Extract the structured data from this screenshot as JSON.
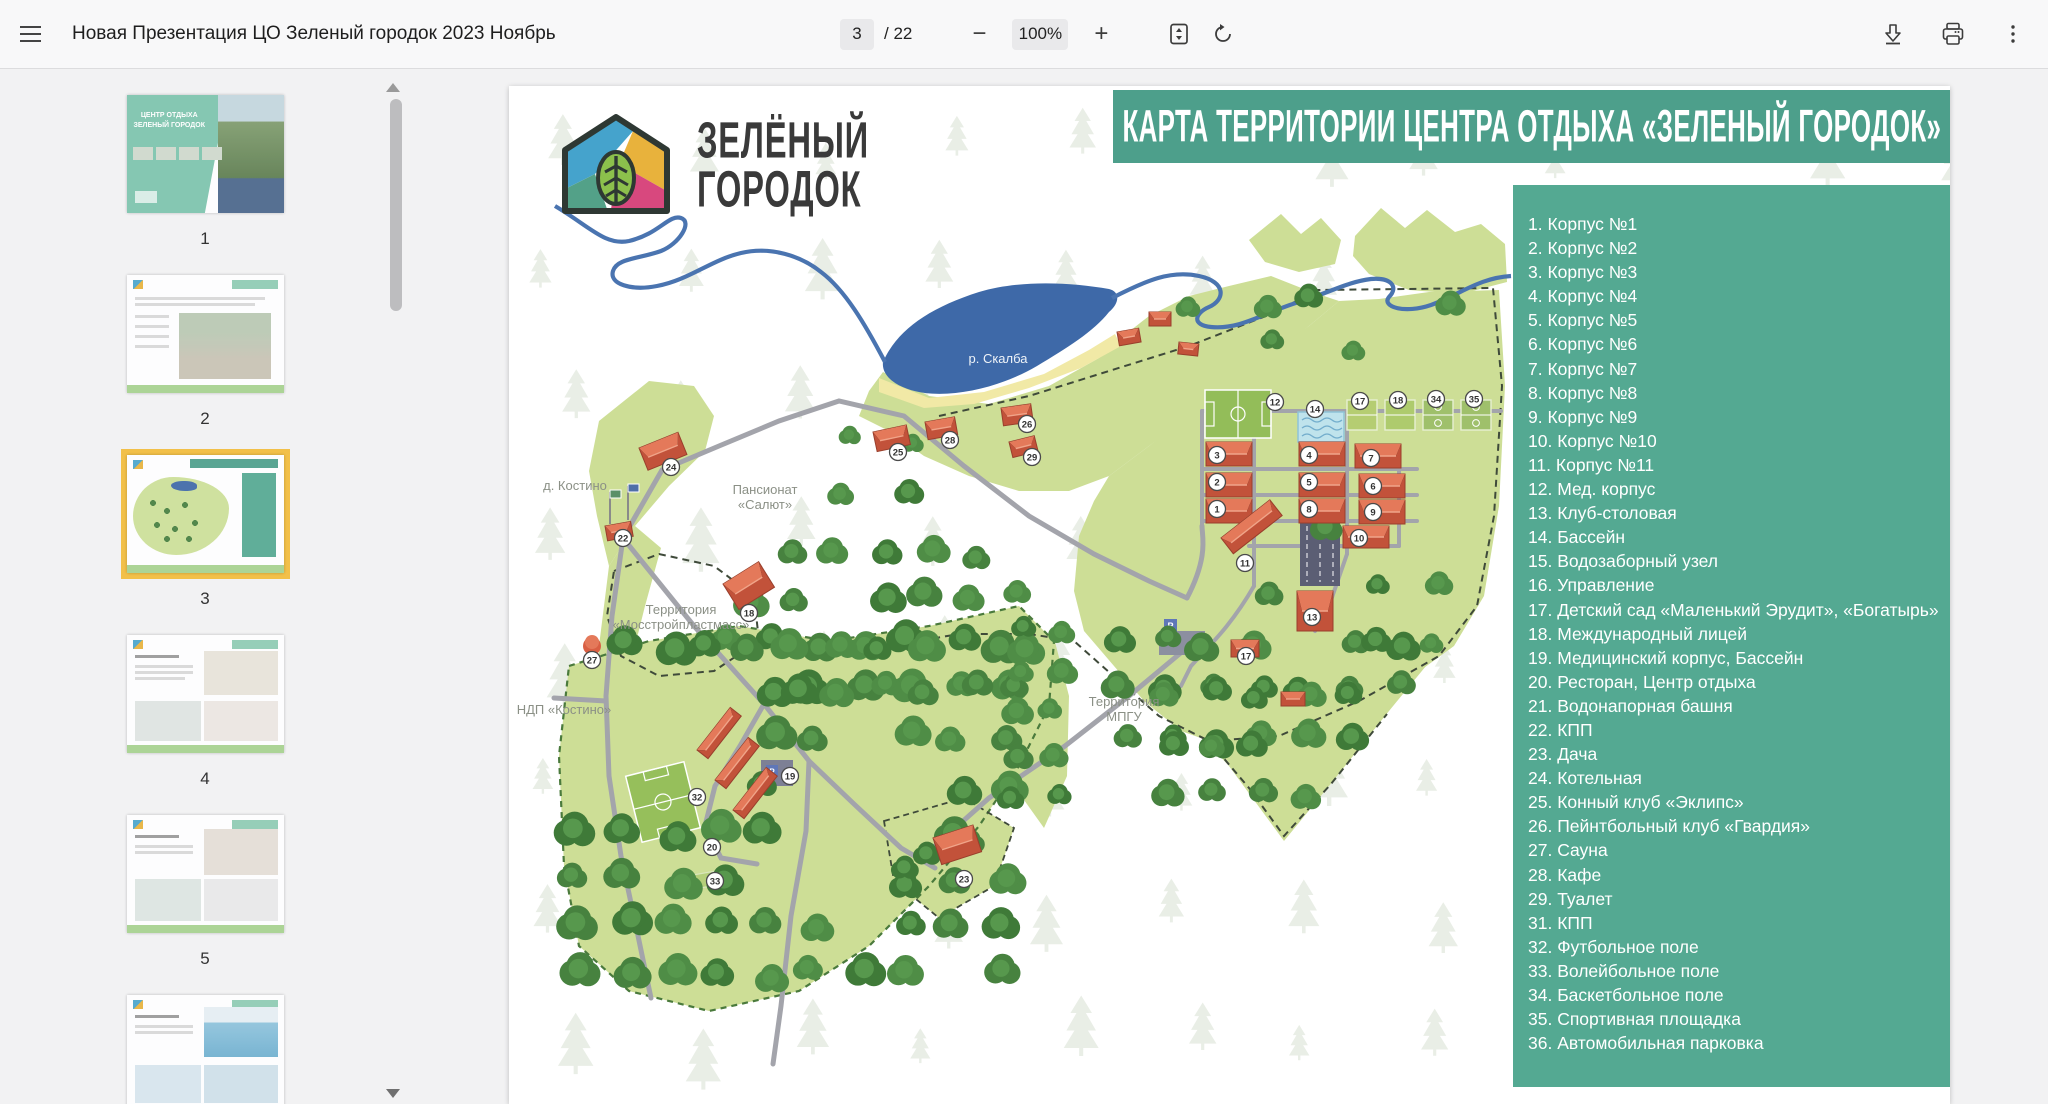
{
  "toolbar": {
    "title": "Новая Презентация ЦО Зеленый городок 2023 Ноябрь",
    "page_current": "3",
    "page_total_label": "/ 22",
    "zoom_level": "100%",
    "accent_color": "#4d9f8b"
  },
  "sidebar": {
    "thumbnails": [
      {
        "num": "1",
        "kind": "cover",
        "selected": false
      },
      {
        "num": "2",
        "kind": "info",
        "selected": false
      },
      {
        "num": "3",
        "kind": "map",
        "selected": true
      },
      {
        "num": "4",
        "kind": "rooms",
        "selected": false
      },
      {
        "num": "5",
        "kind": "rooms2",
        "selected": false
      },
      {
        "num": "6",
        "kind": "pool",
        "selected": false
      }
    ]
  },
  "slide": {
    "logo": {
      "line1": "ЗЕЛЁНЫЙ",
      "line2": "ГОРОДОК"
    },
    "banner_title": "КАРТА ТЕРРИТОРИИ ЦЕНТРА ОТДЫХА «ЗЕЛЕНЫЙ ГОРОДОК»",
    "legend": {
      "panel_color": "#54a992",
      "items": [
        "1. Корпус №1",
        "2. Корпус №2",
        "3. Корпус №3",
        "4. Корпус №4",
        "5. Корпус №5",
        "6. Корпус №6",
        "7. Корпус №7",
        "8. Корпус №8",
        "9. Корпус №9",
        "10. Корпус №10",
        "11. Корпус №11",
        "12. Мед. корпус",
        "13. Клуб-столовая",
        "14. Бассейн",
        "15. Водозаборный узел",
        "16. Управление",
        "17. Детский сад «Маленький Эрудит», «Богатырь»",
        "18. Международный лицей",
        "19. Медицинский корпус, Бассейн",
        "20. Ресторан, Центр отдыха",
        "21. Водонапорная башня",
        "22. КПП",
        "23. Дача",
        "24. Котельная",
        "25. Конный клуб «Эклипс»",
        "26. Пейнтбольный клуб «Гвардия»",
        "27. Сауна",
        "28. Кафе",
        "29. Туалет",
        "31. КПП",
        "32. Футбольное поле",
        "33. Волейбольное поле",
        "34. Баскетбольное поле",
        "35. Спортивная площадка",
        "36. Автомобильная парковка"
      ]
    },
    "map": {
      "labels": [
        {
          "text": "р. Скалба",
          "x": 489,
          "y": 277,
          "white": true
        },
        {
          "text": "д.  Костино",
          "x": 66,
          "y": 404
        },
        {
          "text": "Пансионат\n«Салют»",
          "x": 256,
          "y": 408
        },
        {
          "text": "Территория\n«Мосстройпластмасс»",
          "x": 172,
          "y": 528
        },
        {
          "text": "НДП «Костино»",
          "x": 55,
          "y": 628
        },
        {
          "text": "Территория\nМПГУ",
          "x": 615,
          "y": 620
        }
      ],
      "badges": [
        {
          "n": "24",
          "x": 162,
          "y": 381
        },
        {
          "n": "22",
          "x": 114,
          "y": 452
        },
        {
          "n": "27",
          "x": 83,
          "y": 574
        },
        {
          "n": "18",
          "x": 240,
          "y": 527
        },
        {
          "n": "25",
          "x": 389,
          "y": 366
        },
        {
          "n": "28",
          "x": 441,
          "y": 354
        },
        {
          "n": "26",
          "x": 518,
          "y": 338
        },
        {
          "n": "29",
          "x": 523,
          "y": 371
        },
        {
          "n": "12",
          "x": 766,
          "y": 316
        },
        {
          "n": "14",
          "x": 806,
          "y": 323
        },
        {
          "n": "17",
          "x": 851,
          "y": 315
        },
        {
          "n": "18",
          "x": 889,
          "y": 314
        },
        {
          "n": "34",
          "x": 927,
          "y": 313
        },
        {
          "n": "35",
          "x": 965,
          "y": 313
        },
        {
          "n": "3",
          "x": 708,
          "y": 369
        },
        {
          "n": "2",
          "x": 708,
          "y": 396
        },
        {
          "n": "1",
          "x": 708,
          "y": 423
        },
        {
          "n": "4",
          "x": 800,
          "y": 369
        },
        {
          "n": "5",
          "x": 800,
          "y": 396
        },
        {
          "n": "8",
          "x": 800,
          "y": 423
        },
        {
          "n": "7",
          "x": 862,
          "y": 372
        },
        {
          "n": "6",
          "x": 864,
          "y": 400
        },
        {
          "n": "9",
          "x": 864,
          "y": 426
        },
        {
          "n": "10",
          "x": 850,
          "y": 452
        },
        {
          "n": "11",
          "x": 736,
          "y": 477
        },
        {
          "n": "13",
          "x": 803,
          "y": 531
        },
        {
          "n": "17",
          "x": 737,
          "y": 570
        },
        {
          "n": "19",
          "x": 281,
          "y": 690
        },
        {
          "n": "20",
          "x": 203,
          "y": 761
        },
        {
          "n": "23",
          "x": 455,
          "y": 793
        },
        {
          "n": "32",
          "x": 188,
          "y": 711
        },
        {
          "n": "33",
          "x": 206,
          "y": 795
        }
      ]
    }
  }
}
